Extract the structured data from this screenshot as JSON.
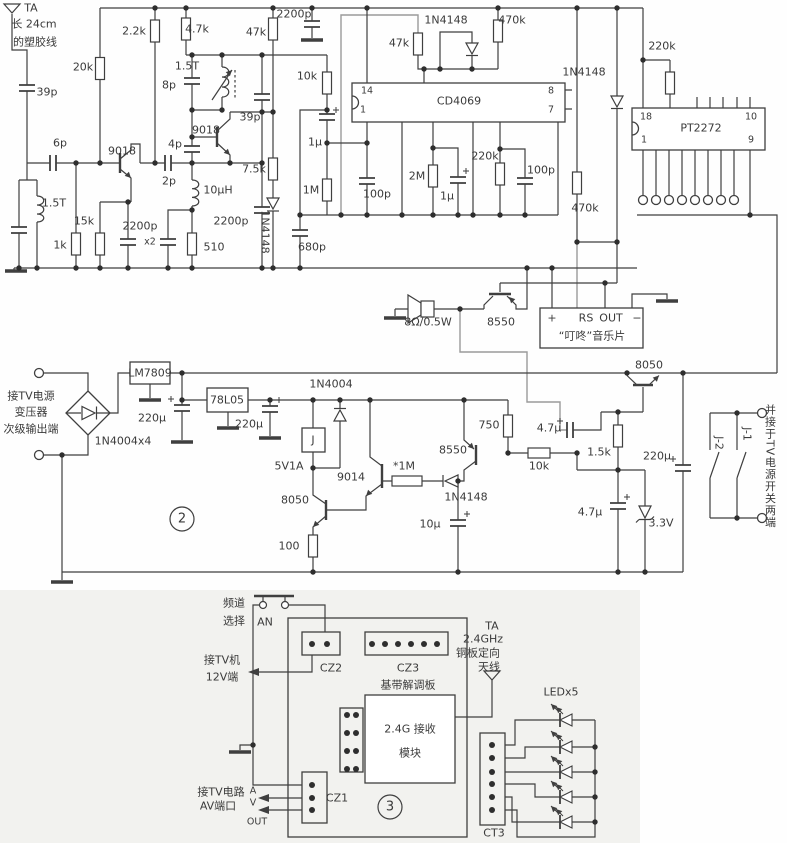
{
  "diagram": {
    "type": "circuit-schematic",
    "subject": "2.4G wireless TV AV receiver with remote power-switch boards",
    "ics": [
      "CD4069",
      "PT2272",
      "LM7809",
      "78L05"
    ],
    "boards": [
      {
        "number": "2",
        "description": "power supply / relay driver board"
      },
      {
        "number": "3",
        "description": "2.4G receiver baseband board"
      }
    ],
    "connectors": [
      "CZ1",
      "CZ2",
      "CZ3",
      "CT3"
    ],
    "music_chip": {
      "pins": [
        "+",
        "RS",
        "OUT",
        "−"
      ],
      "name": "“叮咚”音乐片"
    }
  },
  "labels": [
    {
      "name": "ta-antenna-label",
      "text": "TA",
      "x": 31,
      "y": 8
    },
    {
      "name": "antenna-note-1",
      "text": "长 24cm",
      "x": 34,
      "y": 24
    },
    {
      "name": "antenna-note-2",
      "text": "的塑胶线",
      "x": 35,
      "y": 42
    },
    {
      "name": "cap-39p-a",
      "text": "39p",
      "x": 47,
      "y": 92
    },
    {
      "name": "res-20k",
      "text": "20k",
      "x": 83,
      "y": 67
    },
    {
      "name": "res-2k2",
      "text": "2.2k",
      "x": 134,
      "y": 31
    },
    {
      "name": "res-4k7",
      "text": "4.7k",
      "x": 197,
      "y": 29
    },
    {
      "name": "res-47k-a",
      "text": "47k",
      "x": 256,
      "y": 32
    },
    {
      "name": "cap-2200p-d",
      "text": "2200p",
      "x": 294,
      "y": 14
    },
    {
      "name": "coil-1t5-b",
      "text": "1.5T",
      "x": 187,
      "y": 66
    },
    {
      "name": "cap-8p",
      "text": "8p",
      "x": 169,
      "y": 85
    },
    {
      "name": "cap-39p-b",
      "text": "39p",
      "x": 250,
      "y": 117
    },
    {
      "name": "cap-4p",
      "text": "4p",
      "x": 175,
      "y": 144
    },
    {
      "name": "q-9018-b",
      "text": "9018",
      "x": 206,
      "y": 130
    },
    {
      "name": "q-9018-a",
      "text": "9018",
      "x": 122,
      "y": 151
    },
    {
      "name": "cap-6p-a",
      "text": "6p",
      "x": 60,
      "y": 143
    },
    {
      "name": "cap-2p",
      "text": "2p",
      "x": 169,
      "y": 181
    },
    {
      "name": "coil-10uh",
      "text": "10µH",
      "x": 218,
      "y": 190
    },
    {
      "name": "res-7k5",
      "text": "7.5k",
      "x": 254,
      "y": 169
    },
    {
      "name": "coil-1t5-a",
      "text": "1.5T",
      "x": 54,
      "y": 203
    },
    {
      "name": "res-15k",
      "text": "15k",
      "x": 84,
      "y": 221
    },
    {
      "name": "res-1k",
      "text": "1k",
      "x": 60,
      "y": 245
    },
    {
      "name": "cap-2200p-a",
      "text": "2200p",
      "x": 140,
      "y": 226
    },
    {
      "name": "cap-2200p-x2",
      "text": "x2",
      "x": 150,
      "y": 242,
      "cls": "fs10"
    },
    {
      "name": "res-510",
      "text": "510",
      "x": 214,
      "y": 247
    },
    {
      "name": "cap-2200p-c",
      "text": "2200p",
      "x": 231,
      "y": 221
    },
    {
      "name": "d-1n4148-a",
      "text": "1N4148",
      "x": 265,
      "y": 232,
      "cls": "rot90"
    },
    {
      "name": "res-10k-a",
      "text": "10k",
      "x": 307,
      "y": 76
    },
    {
      "name": "res-47k-b",
      "text": "47k",
      "x": 399,
      "y": 43
    },
    {
      "name": "d-1n4148-b",
      "text": "1N4148",
      "x": 446,
      "y": 20
    },
    {
      "name": "res-470k-a",
      "text": "470k",
      "x": 512,
      "y": 20
    },
    {
      "name": "cd4069-pin14",
      "text": "14",
      "x": 367,
      "y": 91,
      "cls": "fs10"
    },
    {
      "name": "cd4069-pin1",
      "text": "1",
      "x": 363,
      "y": 110,
      "cls": "fs10"
    },
    {
      "name": "ic-cd4069",
      "text": "CD4069",
      "x": 459,
      "y": 101
    },
    {
      "name": "cd4069-pin8",
      "text": "8",
      "x": 551,
      "y": 91,
      "cls": "fs10"
    },
    {
      "name": "cd4069-pin7",
      "text": "7",
      "x": 551,
      "y": 110,
      "cls": "fs10"
    },
    {
      "name": "cap-1u-a",
      "text": "1µ",
      "x": 315,
      "y": 142
    },
    {
      "name": "res-1m",
      "text": "1M",
      "x": 311,
      "y": 190
    },
    {
      "name": "cap-100p-a",
      "text": "100p",
      "x": 377,
      "y": 194
    },
    {
      "name": "res-2m",
      "text": "2M",
      "x": 417,
      "y": 176
    },
    {
      "name": "cap-1u-b",
      "text": "1µ",
      "x": 447,
      "y": 196
    },
    {
      "name": "res-220k-a",
      "text": "220k",
      "x": 485,
      "y": 156
    },
    {
      "name": "cap-100p-b",
      "text": "100p",
      "x": 541,
      "y": 170
    },
    {
      "name": "cap-680p",
      "text": "680p",
      "x": 312,
      "y": 247
    },
    {
      "name": "d-1n4148-c",
      "text": "1N4148",
      "x": 584,
      "y": 72
    },
    {
      "name": "res-220k-b",
      "text": "220k",
      "x": 662,
      "y": 46
    },
    {
      "name": "pt2272-pin18",
      "text": "18",
      "x": 646,
      "y": 117,
      "cls": "fs10"
    },
    {
      "name": "pt2272-pin1",
      "text": "1",
      "x": 644,
      "y": 140,
      "cls": "fs10"
    },
    {
      "name": "ic-pt2272",
      "text": "PT2272",
      "x": 701,
      "y": 128
    },
    {
      "name": "pt2272-pin10",
      "text": "10",
      "x": 751,
      "y": 117,
      "cls": "fs10"
    },
    {
      "name": "pt2272-pin9",
      "text": "9",
      "x": 751,
      "y": 140,
      "cls": "fs10"
    },
    {
      "name": "res-470k-b",
      "text": "470k",
      "x": 585,
      "y": 208
    },
    {
      "name": "speaker-rating",
      "text": "8Ω/0.5W",
      "x": 428,
      "y": 322
    },
    {
      "name": "q-8550-a",
      "text": "8550",
      "x": 501,
      "y": 322
    },
    {
      "name": "music-pin-plus",
      "text": "+",
      "x": 552,
      "y": 318
    },
    {
      "name": "music-pin-rs",
      "text": "RS",
      "x": 586,
      "y": 318
    },
    {
      "name": "music-pin-out",
      "text": "OUT",
      "x": 611,
      "y": 318
    },
    {
      "name": "music-pin-minus",
      "text": "−",
      "x": 637,
      "y": 318
    },
    {
      "name": "music-chip-name",
      "text": "“叮咚”音乐片",
      "x": 592,
      "y": 336
    },
    {
      "name": "q-8050-a",
      "text": "8050",
      "x": 649,
      "y": 365
    },
    {
      "name": "psu-note-1",
      "text": "接TV电源",
      "x": 31,
      "y": 396
    },
    {
      "name": "psu-note-2",
      "text": "变压器",
      "x": 31,
      "y": 412
    },
    {
      "name": "psu-note-3",
      "text": "次级输出端",
      "x": 31,
      "y": 429
    },
    {
      "name": "bridge-1n4004",
      "text": "1N4004x4",
      "x": 123,
      "y": 441
    },
    {
      "name": "ic-lm7809",
      "text": "LM7809",
      "x": 150,
      "y": 373
    },
    {
      "name": "cap-220u-a",
      "text": "220µ",
      "x": 152,
      "y": 418
    },
    {
      "name": "ic-78l05",
      "text": "78L05",
      "x": 227,
      "y": 400
    },
    {
      "name": "cap-220u-b",
      "text": "220µ",
      "x": 249,
      "y": 424
    },
    {
      "name": "board2-number",
      "text": "2",
      "x": 182,
      "y": 519,
      "cls": "fs13"
    },
    {
      "name": "d-1n4004",
      "text": "1N4004",
      "x": 331,
      "y": 384
    },
    {
      "name": "relay-j",
      "text": "J",
      "x": 313,
      "y": 440
    },
    {
      "name": "relay-rating",
      "text": "5V1A",
      "x": 289,
      "y": 466
    },
    {
      "name": "q-9014",
      "text": "9014",
      "x": 351,
      "y": 477
    },
    {
      "name": "res-1m-star",
      "text": "*1M",
      "x": 404,
      "y": 466
    },
    {
      "name": "q-8550-b",
      "text": "8550",
      "x": 453,
      "y": 450
    },
    {
      "name": "res-750",
      "text": "750",
      "x": 489,
      "y": 425
    },
    {
      "name": "d-1n4148-d",
      "text": "1N4148",
      "x": 466,
      "y": 497
    },
    {
      "name": "q-8050-b",
      "text": "8050",
      "x": 295,
      "y": 500
    },
    {
      "name": "res-100",
      "text": "100",
      "x": 289,
      "y": 546
    },
    {
      "name": "cap-10u",
      "text": "10µ",
      "x": 430,
      "y": 524
    },
    {
      "name": "cap-4u7-a",
      "text": "4.7µ",
      "x": 549,
      "y": 428
    },
    {
      "name": "res-10k-b",
      "text": "10k",
      "x": 539,
      "y": 466
    },
    {
      "name": "res-1k5",
      "text": "1.5k",
      "x": 599,
      "y": 452
    },
    {
      "name": "cap-220u-c",
      "text": "220µ",
      "x": 657,
      "y": 456
    },
    {
      "name": "cap-4u7-b",
      "text": "4.7µ",
      "x": 590,
      "y": 512
    },
    {
      "name": "d-zener-3v3",
      "text": "3.3V",
      "x": 661,
      "y": 523
    },
    {
      "name": "relay-contact-j2",
      "text": "J-2",
      "x": 719,
      "y": 443,
      "cls": "rot90"
    },
    {
      "name": "relay-contact-j1",
      "text": "J-1",
      "x": 747,
      "y": 434,
      "cls": "rot90"
    },
    {
      "name": "tv-switch-note",
      "text": "并接于TV电源开关两端",
      "x": 770,
      "y": 466,
      "cls": "vert"
    },
    {
      "name": "channel-note-1",
      "text": "频道",
      "x": 234,
      "y": 603
    },
    {
      "name": "channel-note-2",
      "text": "选择",
      "x": 234,
      "y": 621
    },
    {
      "name": "button-an",
      "text": "AN",
      "x": 265,
      "y": 622
    },
    {
      "name": "conn-cz2",
      "text": "CZ2",
      "x": 331,
      "y": 668
    },
    {
      "name": "conn-cz3",
      "text": "CZ3",
      "x": 408,
      "y": 668
    },
    {
      "name": "board3-name",
      "text": "基带解调板",
      "x": 408,
      "y": 685
    },
    {
      "name": "tv12v-note-1",
      "text": "接TV机",
      "x": 222,
      "y": 660
    },
    {
      "name": "tv12v-note-2",
      "text": "12V端",
      "x": 222,
      "y": 677
    },
    {
      "name": "module-name-1",
      "text": "2.4G 接收",
      "x": 410,
      "y": 729
    },
    {
      "name": "module-name-2",
      "text": "模块",
      "x": 410,
      "y": 753
    },
    {
      "name": "av-note-1",
      "text": "接TV电路",
      "x": 221,
      "y": 792
    },
    {
      "name": "av-note-2",
      "text": "AV端口",
      "x": 218,
      "y": 806
    },
    {
      "name": "av-a",
      "text": "A",
      "x": 253,
      "y": 791,
      "cls": "fs10"
    },
    {
      "name": "av-v",
      "text": "V",
      "x": 253,
      "y": 803,
      "cls": "fs10"
    },
    {
      "name": "av-out",
      "text": "OUT",
      "x": 257,
      "y": 822,
      "cls": "fs10"
    },
    {
      "name": "conn-cz1",
      "text": "CZ1",
      "x": 337,
      "y": 798
    },
    {
      "name": "board3-number",
      "text": "3",
      "x": 390,
      "y": 807,
      "cls": "fs13"
    },
    {
      "name": "ant2-label",
      "text": "TA",
      "x": 492,
      "y": 626
    },
    {
      "name": "ant2-note-1",
      "text": "2.4GHz",
      "x": 483,
      "y": 639
    },
    {
      "name": "ant2-note-2",
      "text": "铜板定向",
      "x": 478,
      "y": 653
    },
    {
      "name": "ant2-note-3",
      "text": "天线",
      "x": 489,
      "y": 667
    },
    {
      "name": "led-count",
      "text": "LEDx5",
      "x": 561,
      "y": 692
    },
    {
      "name": "conn-ct3",
      "text": "CT3",
      "x": 494,
      "y": 833
    }
  ]
}
